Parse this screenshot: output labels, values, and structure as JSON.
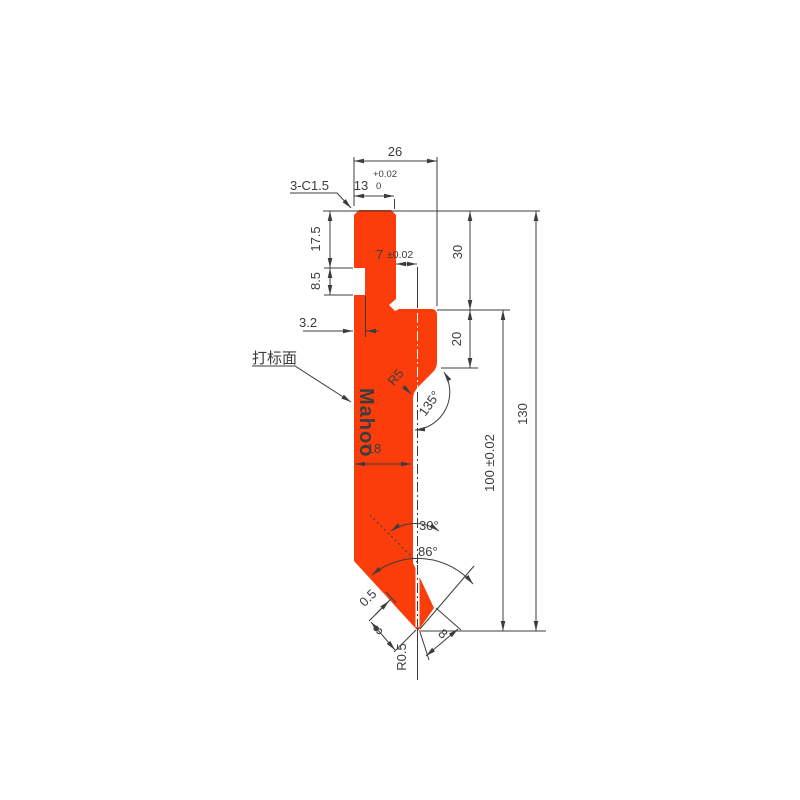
{
  "watermark": "Mahoo",
  "colors": {
    "body": "#fb3d0c",
    "line": "#3c3c3c",
    "watermark": "#ffffff"
  },
  "dimensions": {
    "top_width": "26",
    "shank_width": "13",
    "shank_width_tol_upper": "+0.02",
    "shank_width_tol_lower": "0",
    "chamfer_note": "3-C1.5",
    "upper_height": "17.5",
    "notch_height": "8.5",
    "center_offset": "7",
    "center_offset_tol": "±0.02",
    "shoulder_height": "30",
    "neck_height": "20",
    "notch_depth": "3.2",
    "blade_width": "18",
    "working_height": "100 ±0.02",
    "total_height": "130",
    "neck_radius": "R5",
    "neck_angle": "135°",
    "bend_angle": "30°",
    "tip_angle": "86°",
    "land_width": "0.5",
    "left_face_width": "8",
    "right_face_width": "8",
    "tip_radius": "R0.5",
    "marking_face_label": "打标面"
  }
}
